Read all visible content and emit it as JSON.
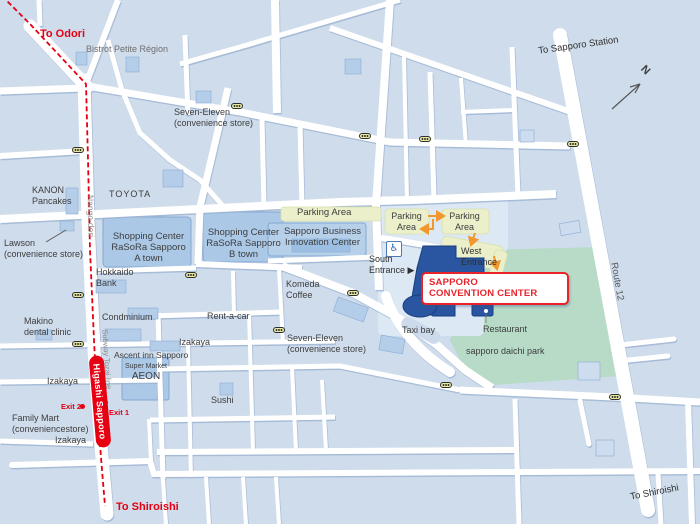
{
  "map": {
    "title": "Sapporo Convention Center access map",
    "labels": {
      "to_odori": "To Odori",
      "bistrot": "Bistrot Petite Région",
      "to_sapporo_station": "To Sapporo Station",
      "compass_n": "N",
      "seven_eleven_north": "Seven-Eleven\n(convenience store)",
      "kanon": "KANON\nPancakes",
      "toyota": "TOYOTA",
      "nango_dori": "Nango-dori",
      "lawson": "Lawson\n(convenience store)",
      "rasora_a": "Shopping Center\nRaSoRa Sapporo\nA town",
      "rasora_b": "Shopping Center\nRaSoRa Sapporo\nB town",
      "hokkaido_bank": "Hokkaido\nBank",
      "parking_area_top": "Parking Area",
      "innovation_center": "Sapporo Business\nInnovation Center",
      "parking_area_1": "Parking\nArea",
      "parking_area_2": "Parking\nArea",
      "west_entrance": "West\nEntrance",
      "south_entrance": "South\nEntrance ▶",
      "convention_center": "SAPPORO\nCONVENTION CENTER",
      "komeda": "Komeda\nCoffee",
      "route_12": "Route 12",
      "makino": "Makino\ndental clinic",
      "condminium": "Condminium",
      "rent_a_car": "Rent-a-car",
      "izakaya_ne": "Izakaya",
      "ascent_inn": "Ascent inn Sapporo",
      "super_market": "Super Market",
      "aeon": "AEON",
      "subway_tozai": "Subway Tozai line",
      "higashi_sapporo": "Higashi Sapporo",
      "exit_1": "Exit 1",
      "exit_2": "Exit 2",
      "family_mart": "Family Mart\n(conveniencestore)",
      "izakaya_w": "Izakaya",
      "izakaya_sw": "Izakaya",
      "sushi": "Sushi",
      "seven_eleven_south": "Seven-Eleven\n(convenience store)",
      "taxi_bay": "Taxi bay",
      "restaurant": "Restaurant",
      "daichi_park": "sapporo daichi park",
      "to_shiroishi_subway": "To Shiroishi",
      "to_shiroishi_route": "To Shiroishi"
    },
    "icons": {
      "accessibility_glyph": "♿",
      "traffic_light": "yellow capsule with three dots",
      "subway_station_marker": "red capsule",
      "compass": "north arrow"
    },
    "colors": {
      "background": "#cfdcec",
      "road": "#ffffff",
      "park_green": "#b7dbc7",
      "parking_yellow": "#ebf0ca",
      "building_blue": "#abc9e7",
      "convention_building": "#2a55a0",
      "subway_red": "#e60012",
      "label_red": "#e8232a",
      "arrow_orange": "#f0972e"
    }
  }
}
